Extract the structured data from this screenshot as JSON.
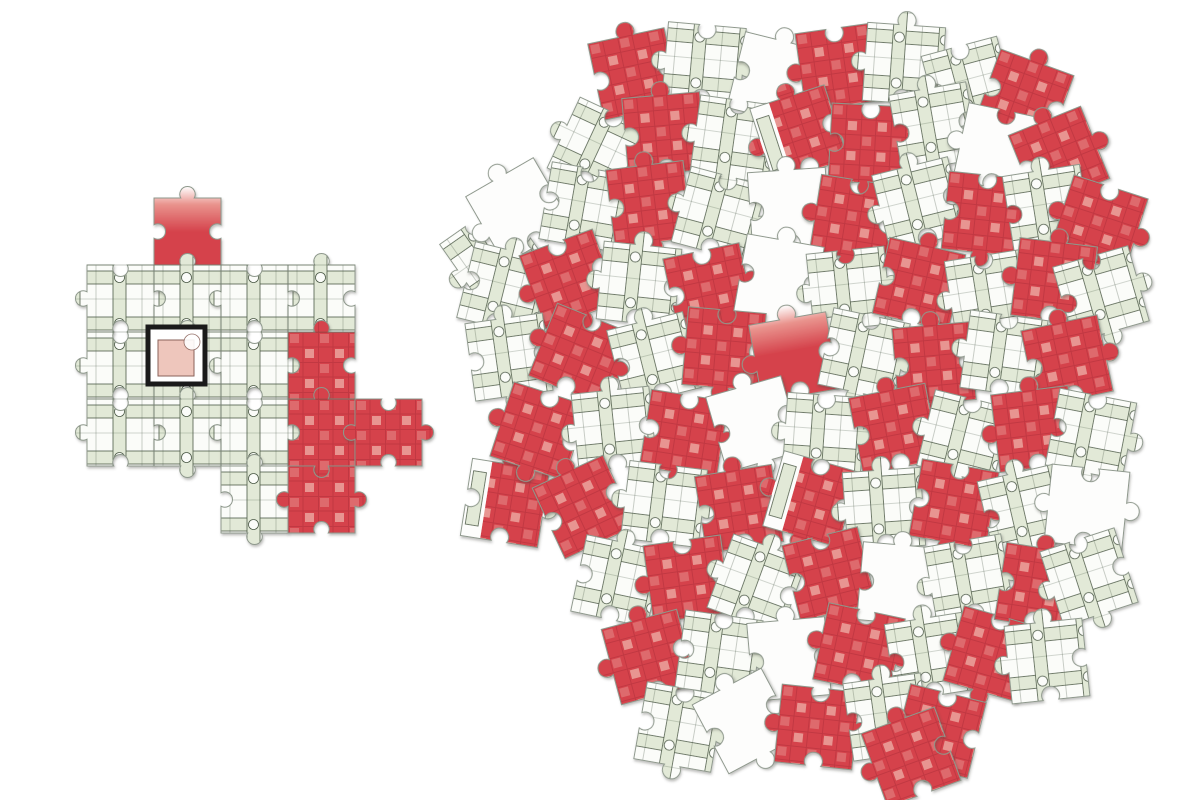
{
  "scene": {
    "description": "Illustration of a jigsaw puzzle: a small partially assembled section on the left depicting a pale-green floor-plan maze with red plaid patches and a black-framed courtyard marker with a pink square, one loose red piece in the middle, and a large round pile of scattered unassembled pieces on the right.",
    "background": "#ffffff"
  },
  "palette": {
    "red": "#d5434c",
    "red_dark": "#bd3741",
    "red_light": "#e99a94",
    "green": "#e2e9d7",
    "green_line": "#4c5a47",
    "paper": "#fbfcf9",
    "white_piece": "#fdfdfc",
    "outline": "#8e988c",
    "black": "#1a1a1a",
    "pink": "#eec6bc",
    "pink_border": "#8a625a",
    "shadow": "#4a4a42"
  },
  "piece_geometry": {
    "pile_piece_size": 78,
    "assembled_piece_size": 67,
    "knob_radius_ratio": 0.115,
    "neck_span": [
      0.4,
      0.6
    ]
  },
  "shapes": [
    [
      1,
      -1,
      1,
      -1
    ],
    [
      -1,
      1,
      -1,
      1
    ],
    [
      1,
      1,
      -1,
      -1
    ],
    [
      -1,
      -1,
      1,
      1
    ],
    [
      1,
      -1,
      -1,
      1
    ],
    [
      -1,
      1,
      1,
      -1
    ]
  ],
  "variants": {
    "0": "floor-plan",
    "1": "red-plaid",
    "2": "blank-white",
    "3": "mixed-plaid-white",
    "4": "red-fade"
  },
  "piece_format": "[x, y, rotation_deg, variant]",
  "assembled": {
    "origin": [
      87,
      198
    ],
    "step": 67,
    "pieces": [
      [
        67,
        0,
        4
      ],
      [
        0,
        67,
        0
      ],
      [
        67,
        67,
        0
      ],
      [
        134,
        67,
        0
      ],
      [
        201,
        67,
        0
      ],
      [
        0,
        134,
        0
      ],
      [
        67,
        134,
        0
      ],
      [
        134,
        134,
        0
      ],
      [
        201,
        134,
        1
      ],
      [
        0,
        201,
        0
      ],
      [
        67,
        201,
        0
      ],
      [
        134,
        201,
        0
      ],
      [
        201,
        201,
        1
      ],
      [
        268,
        201,
        1
      ],
      [
        134,
        268,
        0
      ],
      [
        201,
        268,
        1
      ]
    ],
    "grid_lines": {
      "verticals": [
        154,
        221,
        288
      ],
      "horizontals": [
        265,
        332,
        399
      ],
      "x_range": [
        87,
        355
      ],
      "y_range": [
        265,
        466
      ]
    },
    "centerpiece": {
      "x": 148,
      "y": 327,
      "outer": 57,
      "inner": 36,
      "inner_dx": 10,
      "inner_dy": 13,
      "notch_r": 8
    }
  },
  "loose_piece": {
    "x": 466,
    "y": 464,
    "rot": 9,
    "variant": 3,
    "shape": 2
  },
  "pile": {
    "pieces": [
      [
        595,
        35,
        -12,
        1
      ],
      [
        665,
        25,
        5,
        0
      ],
      [
        735,
        40,
        14,
        2
      ],
      [
        800,
        28,
        -8,
        1
      ],
      [
        865,
        25,
        4,
        0
      ],
      [
        930,
        45,
        -15,
        0
      ],
      [
        985,
        60,
        20,
        1
      ],
      [
        560,
        110,
        25,
        0
      ],
      [
        625,
        95,
        -5,
        1
      ],
      [
        695,
        100,
        8,
        0
      ],
      [
        760,
        95,
        -18,
        3
      ],
      [
        830,
        105,
        3,
        1
      ],
      [
        895,
        88,
        -10,
        0
      ],
      [
        960,
        110,
        12,
        2
      ],
      [
        1020,
        118,
        -22,
        1
      ],
      [
        455,
        215,
        -35,
        0
      ],
      [
        480,
        172,
        -30,
        2
      ],
      [
        545,
        168,
        10,
        0
      ],
      [
        610,
        165,
        -7,
        1
      ],
      [
        680,
        175,
        15,
        0
      ],
      [
        750,
        170,
        -4,
        2
      ],
      [
        815,
        180,
        9,
        1
      ],
      [
        880,
        165,
        -14,
        0
      ],
      [
        945,
        175,
        6,
        1
      ],
      [
        1008,
        170,
        -9,
        0
      ],
      [
        1060,
        185,
        18,
        1
      ],
      [
        465,
        250,
        14,
        0
      ],
      [
        530,
        240,
        -20,
        1
      ],
      [
        600,
        245,
        6,
        0
      ],
      [
        670,
        250,
        -12,
        1
      ],
      [
        740,
        240,
        10,
        2
      ],
      [
        810,
        250,
        -6,
        0
      ],
      [
        880,
        245,
        13,
        1
      ],
      [
        950,
        255,
        -9,
        0
      ],
      [
        1015,
        242,
        7,
        1
      ],
      [
        1062,
        255,
        -16,
        0
      ],
      [
        470,
        318,
        -8,
        0
      ],
      [
        540,
        315,
        22,
        1
      ],
      [
        615,
        320,
        -14,
        0
      ],
      [
        685,
        310,
        5,
        1
      ],
      [
        755,
        318,
        -10,
        4
      ],
      [
        825,
        315,
        12,
        0
      ],
      [
        895,
        325,
        -5,
        1
      ],
      [
        965,
        315,
        8,
        0
      ],
      [
        1028,
        322,
        -12,
        1
      ],
      [
        500,
        392,
        18,
        1
      ],
      [
        575,
        390,
        -6,
        0
      ],
      [
        645,
        395,
        9,
        1
      ],
      [
        715,
        385,
        -16,
        2
      ],
      [
        785,
        395,
        4,
        0
      ],
      [
        855,
        390,
        -11,
        1
      ],
      [
        925,
        398,
        14,
        0
      ],
      [
        995,
        390,
        -7,
        1
      ],
      [
        1052,
        395,
        11,
        0
      ],
      [
        545,
        468,
        -25,
        1
      ],
      [
        625,
        465,
        7,
        0
      ],
      [
        700,
        470,
        -9,
        1
      ],
      [
        772,
        460,
        16,
        3
      ],
      [
        845,
        470,
        -4,
        0
      ],
      [
        915,
        465,
        10,
        1
      ],
      [
        985,
        472,
        -13,
        0
      ],
      [
        1048,
        468,
        6,
        2
      ],
      [
        578,
        542,
        12,
        0
      ],
      [
        648,
        540,
        -8,
        1
      ],
      [
        718,
        545,
        20,
        0
      ],
      [
        790,
        535,
        -14,
        1
      ],
      [
        860,
        545,
        5,
        2
      ],
      [
        930,
        540,
        -10,
        0
      ],
      [
        1000,
        548,
        9,
        1
      ],
      [
        1050,
        538,
        -18,
        0
      ],
      [
        610,
        618,
        -15,
        1
      ],
      [
        680,
        615,
        8,
        0
      ],
      [
        750,
        620,
        -5,
        2
      ],
      [
        820,
        610,
        12,
        1
      ],
      [
        890,
        618,
        -9,
        0
      ],
      [
        952,
        615,
        16,
        1
      ],
      [
        1008,
        622,
        -6,
        0
      ],
      [
        640,
        688,
        10,
        0
      ],
      [
        706,
        682,
        -28,
        2
      ],
      [
        778,
        688,
        6,
        1
      ],
      [
        848,
        678,
        -8,
        0
      ],
      [
        900,
        692,
        14,
        1
      ],
      [
        872,
        718,
        -20,
        1
      ]
    ]
  },
  "stats": {
    "assembled_piece_count": 16,
    "pile_piece_count": 83,
    "loose_piece_count": 1
  }
}
